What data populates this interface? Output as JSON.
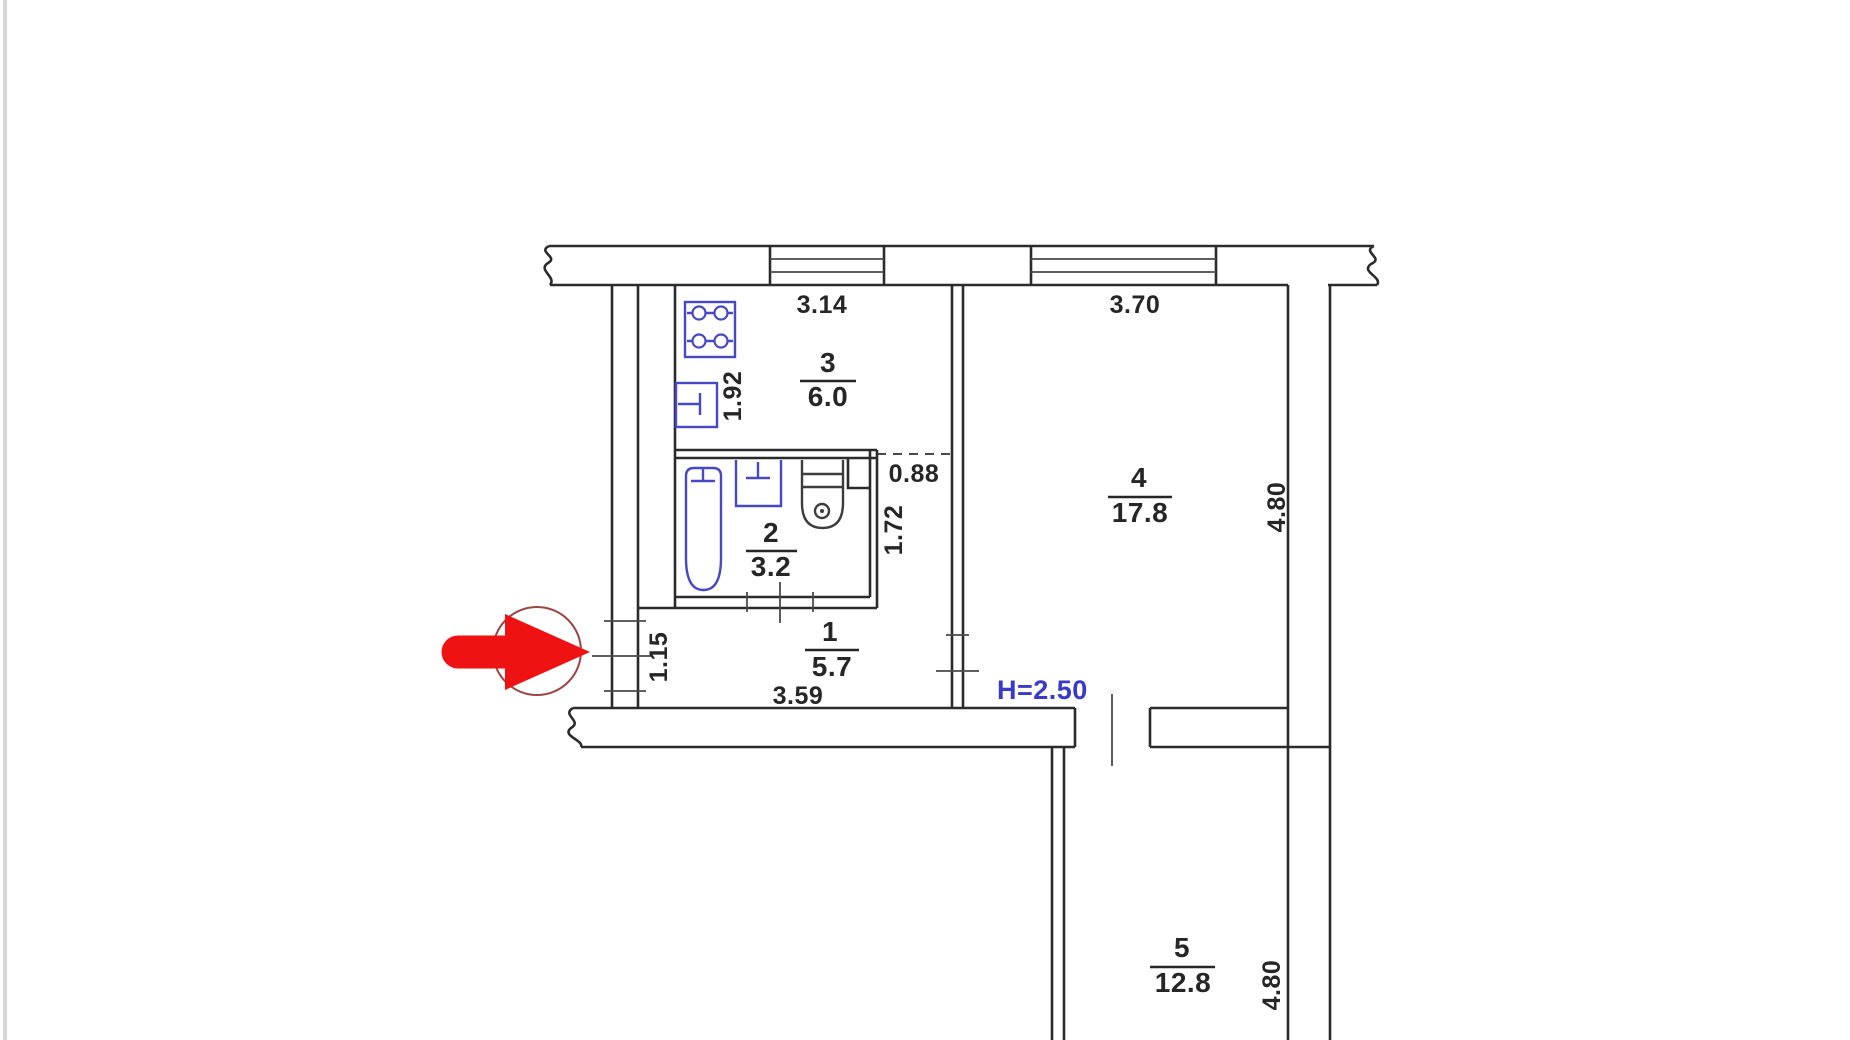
{
  "document": {
    "type": "apartment-floor-plan"
  },
  "rooms": {
    "hallway": {
      "number": "1",
      "area": "5.7"
    },
    "bathroom": {
      "number": "2",
      "area": "3.2"
    },
    "kitchen": {
      "number": "3",
      "area": "6.0"
    },
    "living_room": {
      "number": "4",
      "area": "17.8"
    },
    "room5": {
      "number": "5",
      "area": "12.8"
    }
  },
  "dimensions": {
    "kitchen_width": "3.14",
    "kitchen_depth": "1.92",
    "niche_width": "0.88",
    "bathroom_depth": "1.72",
    "entry_width": "1.15",
    "hallway_width": "3.59",
    "living_width": "3.70",
    "living_depth": "4.80",
    "room5_depth": "4.80"
  },
  "annotations": {
    "ceiling_height": "H=2.50"
  },
  "colors": {
    "wall": "#2b2b2b",
    "fixture_blue": "#4848c4",
    "toilet_grey": "#3d3d3d",
    "height_note_blue": "#3a3ac8",
    "arrow_red": "#ee1212",
    "arrow_circle_maroon": "#9b4545"
  }
}
